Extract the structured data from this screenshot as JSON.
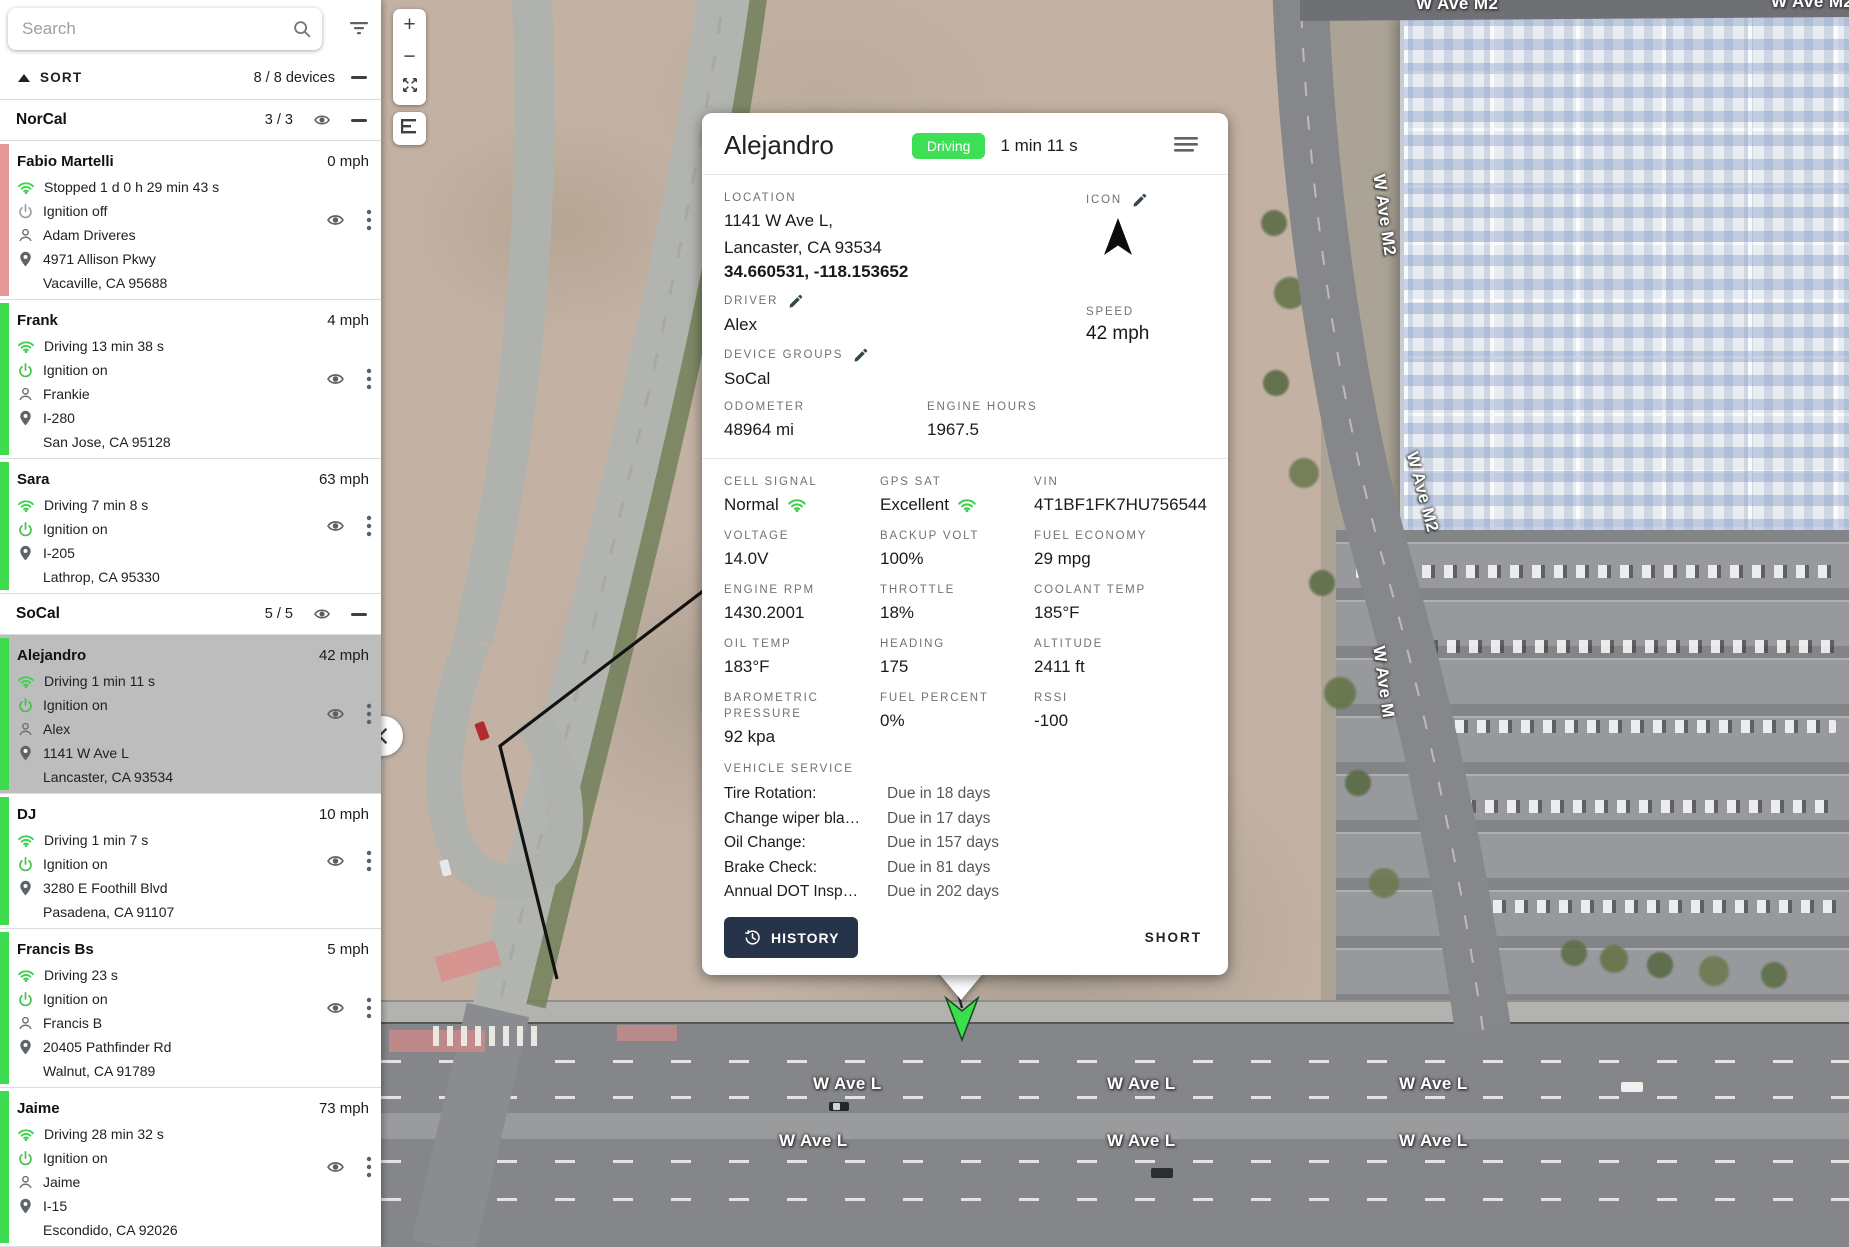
{
  "sidebar": {
    "search": {
      "placeholder": "Search"
    },
    "sort": {
      "label": "SORT",
      "count": "8 / 8 devices"
    },
    "groups": [
      {
        "name": "NorCal",
        "count": "3 / 3",
        "devices": [
          {
            "name": "Fabio Martelli",
            "speed": "0 mph",
            "status": "Stopped 1 d 0 h 29 min 43 s",
            "ignition": "Ignition off",
            "ignition_on": false,
            "driver": "Adam Driveres",
            "address1": "4971 Allison Pkwy",
            "address2": "Vacaville, CA 95688",
            "bar_color": "pink",
            "selected": false
          },
          {
            "name": "Frank",
            "speed": "4 mph",
            "status": "Driving 13 min 38 s",
            "ignition": "Ignition on",
            "ignition_on": true,
            "driver": "Frankie",
            "address1": "I-280",
            "address2": "San Jose, CA 95128",
            "bar_color": "green",
            "selected": false
          },
          {
            "name": "Sara",
            "speed": "63 mph",
            "status": "Driving 7 min 8 s",
            "ignition": "Ignition on",
            "ignition_on": true,
            "driver": null,
            "address1": "I-205",
            "address2": "Lathrop, CA 95330",
            "bar_color": "green",
            "selected": false
          }
        ]
      },
      {
        "name": "SoCal",
        "count": "5 / 5",
        "devices": [
          {
            "name": "Alejandro",
            "speed": "42 mph",
            "status": "Driving 1 min 11 s",
            "ignition": "Ignition on",
            "ignition_on": true,
            "driver": "Alex",
            "address1": "1141 W Ave L",
            "address2": "Lancaster, CA 93534",
            "bar_color": "green",
            "selected": true
          },
          {
            "name": "DJ",
            "speed": "10 mph",
            "status": "Driving 1 min 7 s",
            "ignition": "Ignition on",
            "ignition_on": true,
            "driver": null,
            "address1": "3280 E Foothill Blvd",
            "address2": "Pasadena, CA 91107",
            "bar_color": "green",
            "selected": false
          },
          {
            "name": "Francis Bs",
            "speed": "5 mph",
            "status": "Driving 23 s",
            "ignition": "Ignition on",
            "ignition_on": true,
            "driver": "Francis B",
            "address1": "20405 Pathfinder Rd",
            "address2": "Walnut, CA 91789",
            "bar_color": "green",
            "selected": false
          },
          {
            "name": "Jaime",
            "speed": "73 mph",
            "status": "Driving 28 min 32 s",
            "ignition": "Ignition on",
            "ignition_on": true,
            "driver": "Jaime",
            "address1": "I-15",
            "address2": "Escondido, CA 92026",
            "bar_color": "green",
            "selected": false
          }
        ]
      }
    ]
  },
  "card": {
    "title": "Alejandro",
    "status_badge": "Driving",
    "duration": "1 min 11 s",
    "location": {
      "label": "LOCATION",
      "line1": "1141 W Ave L,",
      "line2": "Lancaster, CA 93534",
      "coords": "34.660531, -118.153652"
    },
    "icon_field": {
      "label": "ICON"
    },
    "driver": {
      "label": "DRIVER",
      "value": "Alex"
    },
    "device_groups": {
      "label": "DEVICE GROUPS",
      "value": "SoCal"
    },
    "odometer": {
      "label": "ODOMETER",
      "value": "48964 mi"
    },
    "engine_hours": {
      "label": "ENGINE HOURS",
      "value": "1967.5"
    },
    "speed": {
      "label": "SPEED",
      "value": "42 mph"
    },
    "stats": [
      {
        "label": "CELL SIGNAL",
        "value": "Normal",
        "wifi": true
      },
      {
        "label": "GPS SAT",
        "value": "Excellent",
        "wifi": true
      },
      {
        "label": "VIN",
        "value": "4T1BF1FK7HU756544",
        "wifi": false
      },
      {
        "label": "VOLTAGE",
        "value": "14.0V",
        "wifi": false
      },
      {
        "label": "BACKUP VOLT",
        "value": "100%",
        "wifi": false
      },
      {
        "label": "FUEL ECONOMY",
        "value": "29 mpg",
        "wifi": false
      },
      {
        "label": "ENGINE RPM",
        "value": "1430.2001",
        "wifi": false
      },
      {
        "label": "THROTTLE",
        "value": "18%",
        "wifi": false
      },
      {
        "label": "COOLANT TEMP",
        "value": "185°F",
        "wifi": false
      },
      {
        "label": "OIL TEMP",
        "value": "183°F",
        "wifi": false
      },
      {
        "label": "HEADING",
        "value": "175",
        "wifi": false
      },
      {
        "label": "ALTITUDE",
        "value": "2411 ft",
        "wifi": false
      },
      {
        "label": "BAROMETRIC PRESSURE",
        "value": "92 kpa",
        "wifi": false
      },
      {
        "label": "FUEL PERCENT",
        "value": "0%",
        "wifi": false
      },
      {
        "label": "RSSI",
        "value": "-100",
        "wifi": false
      }
    ],
    "vehicle_service": {
      "label": "VEHICLE SERVICE",
      "items": [
        {
          "name": "Tire Rotation:",
          "due": "Due in 18 days"
        },
        {
          "name": "Change wiper bla…",
          "due": "Due in 17 days"
        },
        {
          "name": "Oil Change:",
          "due": "Due in 157 days"
        },
        {
          "name": "Brake Check:",
          "due": "Due in 81 days"
        },
        {
          "name": "Annual DOT Insp…",
          "due": "Due in 202 days"
        }
      ]
    },
    "history_button": "HISTORY",
    "short_link": "SHORT"
  },
  "map": {
    "controls": {
      "zoom_in": "+",
      "zoom_out": "−"
    },
    "road_labels": [
      {
        "text": "W Ave L",
        "x": 432,
        "y": 1074,
        "rot": 0
      },
      {
        "text": "W Ave L",
        "x": 726,
        "y": 1074,
        "rot": 0
      },
      {
        "text": "W Ave L",
        "x": 1018,
        "y": 1074,
        "rot": 0
      },
      {
        "text": "W Ave L",
        "x": 398,
        "y": 1131,
        "rot": 0
      },
      {
        "text": "W Ave L",
        "x": 726,
        "y": 1131,
        "rot": 0
      },
      {
        "text": "W Ave L",
        "x": 1018,
        "y": 1131,
        "rot": 0
      },
      {
        "text": "W Ave M2",
        "x": 1035,
        "y": -6,
        "rot": 0
      },
      {
        "text": "W Ave M2",
        "x": 1390,
        "y": -8,
        "rot": 0
      },
      {
        "text": "W Ave M2",
        "x": 962,
        "y": 205,
        "rot": 82
      },
      {
        "text": "W Ave M2",
        "x": 1000,
        "y": 482,
        "rot": 75
      },
      {
        "text": "W Ave M",
        "x": 966,
        "y": 672,
        "rot": 82
      }
    ]
  },
  "colors": {
    "accent_green": "#3fdb4f",
    "stopped_pink": "#e59896",
    "selected_gray": "#bdbdbd",
    "history_navy": "#263348",
    "badge_green": "#3fdf55"
  }
}
